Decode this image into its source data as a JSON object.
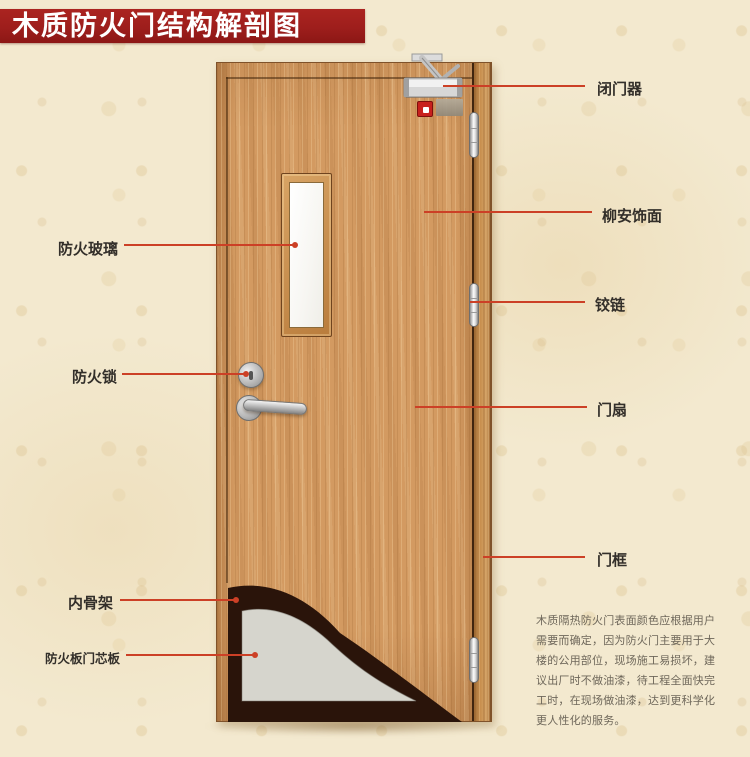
{
  "title": "木质防火门结构解剖图",
  "left_labels": [
    {
      "id": "fire-glass",
      "text": "防火玻璃"
    },
    {
      "id": "fire-lock",
      "text": "防火锁"
    },
    {
      "id": "inner-skeleton",
      "text": "内骨架"
    },
    {
      "id": "core-board",
      "text": "防火板门芯板"
    }
  ],
  "right_labels": [
    {
      "id": "door-closer",
      "text": "闭门器"
    },
    {
      "id": "lauan-veneer",
      "text": "柳安饰面"
    },
    {
      "id": "hinge",
      "text": "铰链"
    },
    {
      "id": "door-leaf",
      "text": "门扇"
    },
    {
      "id": "door-frame",
      "text": "门框"
    }
  ],
  "description_lines": [
    "木质隔热防火门表面颜色应根据用户",
    "需要而确定，因为防火门主要用于大",
    "楼的公用部位，现场施工易损坏，建",
    "议出厂时不做油漆，待工程全面快完",
    "工时，在现场做油漆，达到更科学化",
    "更人性化的服务。"
  ],
  "colors": {
    "banner": "#9e1e1c",
    "leader_line": "#cc4026",
    "door_wood": "#d39a61",
    "core_board": "#d6d5cd",
    "skeleton": "#2a140a",
    "glass": "#f7f6f2"
  }
}
